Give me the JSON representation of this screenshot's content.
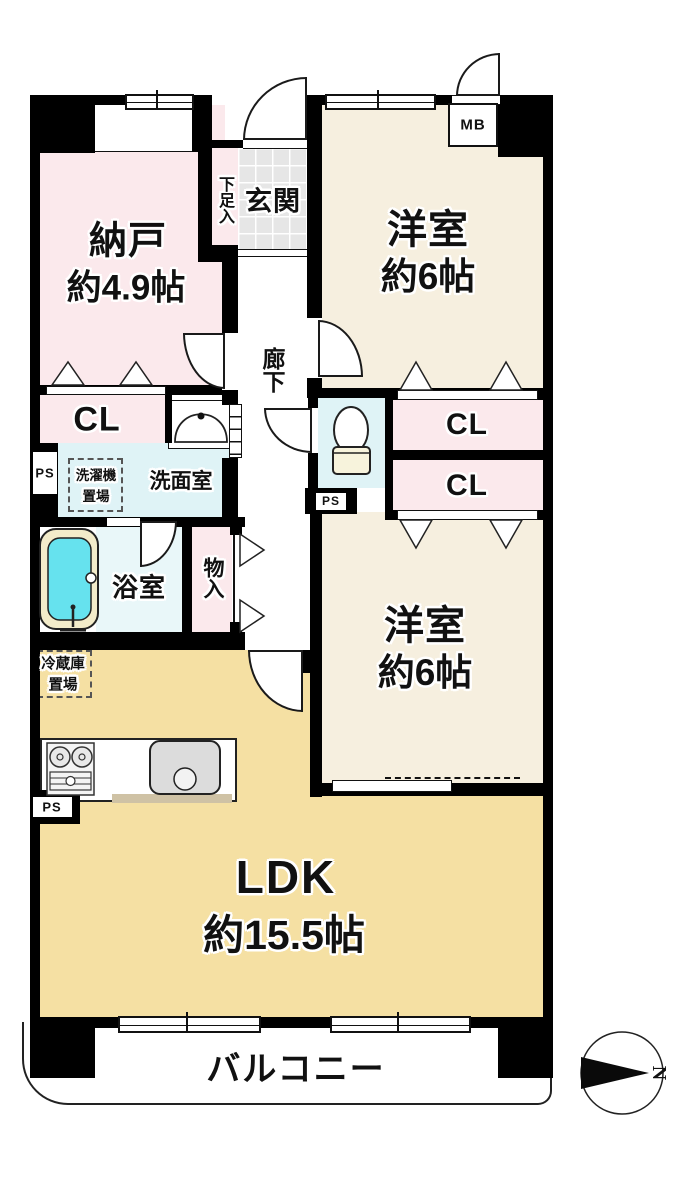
{
  "plan": {
    "rooms": {
      "nando": {
        "label": "納戸",
        "area": "約4.9帖"
      },
      "genkan": {
        "label": "玄関"
      },
      "shoes": {
        "label": "下足入"
      },
      "western1": {
        "label": "洋室",
        "area": "約6帖"
      },
      "mb": {
        "label": "MB"
      },
      "cl_nando": {
        "label": "CL"
      },
      "corridor": {
        "label": "廊下"
      },
      "washer": {
        "line1": "洗濯機",
        "line2": "置場"
      },
      "washroom": {
        "label": "洗面室"
      },
      "ps_left": {
        "label": "PS"
      },
      "ps_toilet": {
        "label": "PS"
      },
      "ps_kitchen": {
        "label": "PS"
      },
      "cl1": {
        "label": "CL"
      },
      "cl2": {
        "label": "CL"
      },
      "bathroom": {
        "label": "浴室"
      },
      "monoire": {
        "label": "物入"
      },
      "western2": {
        "label": "洋室",
        "area": "約6帖"
      },
      "fridge": {
        "line1": "冷蔵庫",
        "line2": "置場"
      },
      "ldk": {
        "label": "LDK",
        "area": "約15.5帖"
      },
      "balcony": {
        "label": "バルコニー"
      }
    },
    "compass": {
      "label": "N"
    },
    "colors": {
      "room_pink": "#fbe9ec",
      "room_cream": "#f6efdf",
      "ldk_tan": "#f5e0a3",
      "wet_blue": "#dff3f6",
      "bath_blue": "#e9f7f9",
      "tub_cyan": "#66e2ee",
      "tub_rim": "#f3ecca",
      "tile_gray": "#e6e6e6",
      "wall": "#000000"
    }
  }
}
